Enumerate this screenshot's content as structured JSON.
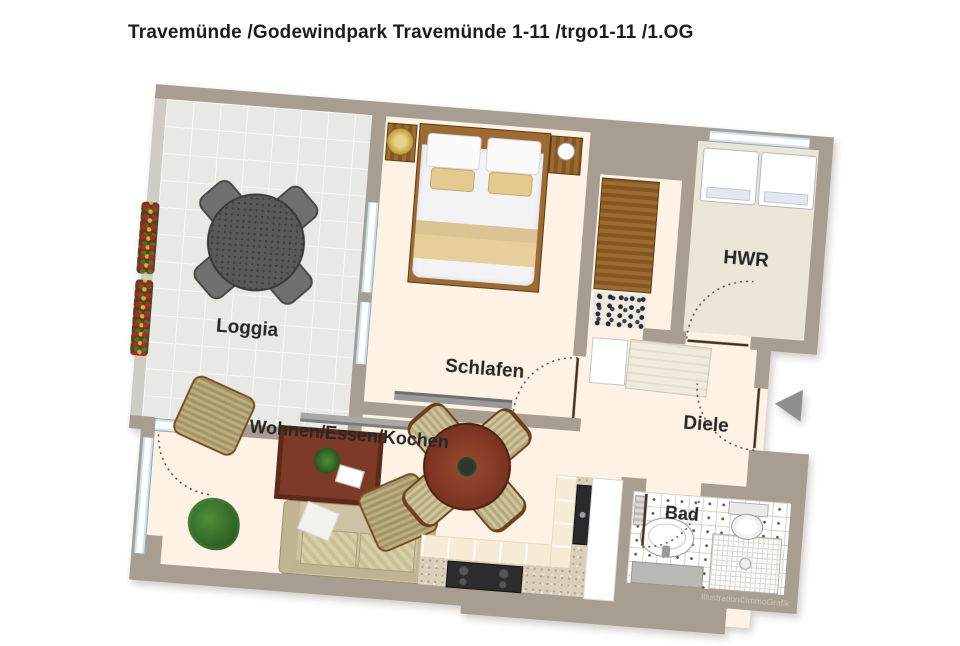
{
  "title": "Travemünde /Godewindpark Travemünde 1-11 /trgo1-11 /1.OG",
  "watermark": "Illustration©immoGrafik",
  "rooms": [
    {
      "id": "loggia",
      "label": "Loggia"
    },
    {
      "id": "schlafen",
      "label": "Schlafen"
    },
    {
      "id": "hwr",
      "label": "HWR"
    },
    {
      "id": "diele",
      "label": "Diele"
    },
    {
      "id": "wohnen",
      "label": "Wohnen/Essen/Kochen"
    },
    {
      "id": "bad",
      "label": "Bad"
    }
  ],
  "colors": {
    "wall": "#a79d91",
    "parapet": "#cfccc5",
    "floor_cream": "#fdf2e4",
    "loggia_tile": "#e8e8e5",
    "hwr_floor": "#ece6d9",
    "bath_tile": "#ffffff",
    "counter_speckle": "#d9cfba",
    "wood": "#9c6a33",
    "entry_arrow": "#8f8f8f",
    "window_blue": "#cfe2ea"
  },
  "furniture": [
    "balcony-table",
    "balcony-chair",
    "flower-box",
    "double-bed",
    "nightstand",
    "bedside-lamp",
    "tv-board",
    "sideboard",
    "wardrobe",
    "shoe-rack",
    "washing-machine",
    "dryer",
    "hall-cabinet",
    "hall-closet",
    "armchair",
    "coffee-table",
    "sofa",
    "houseplant",
    "dining-table",
    "dining-chair",
    "kitchen-counter",
    "cooktop",
    "kitchen-sink",
    "tall-cabinet",
    "toilet",
    "washbasin",
    "vanity",
    "shower",
    "radiator"
  ]
}
